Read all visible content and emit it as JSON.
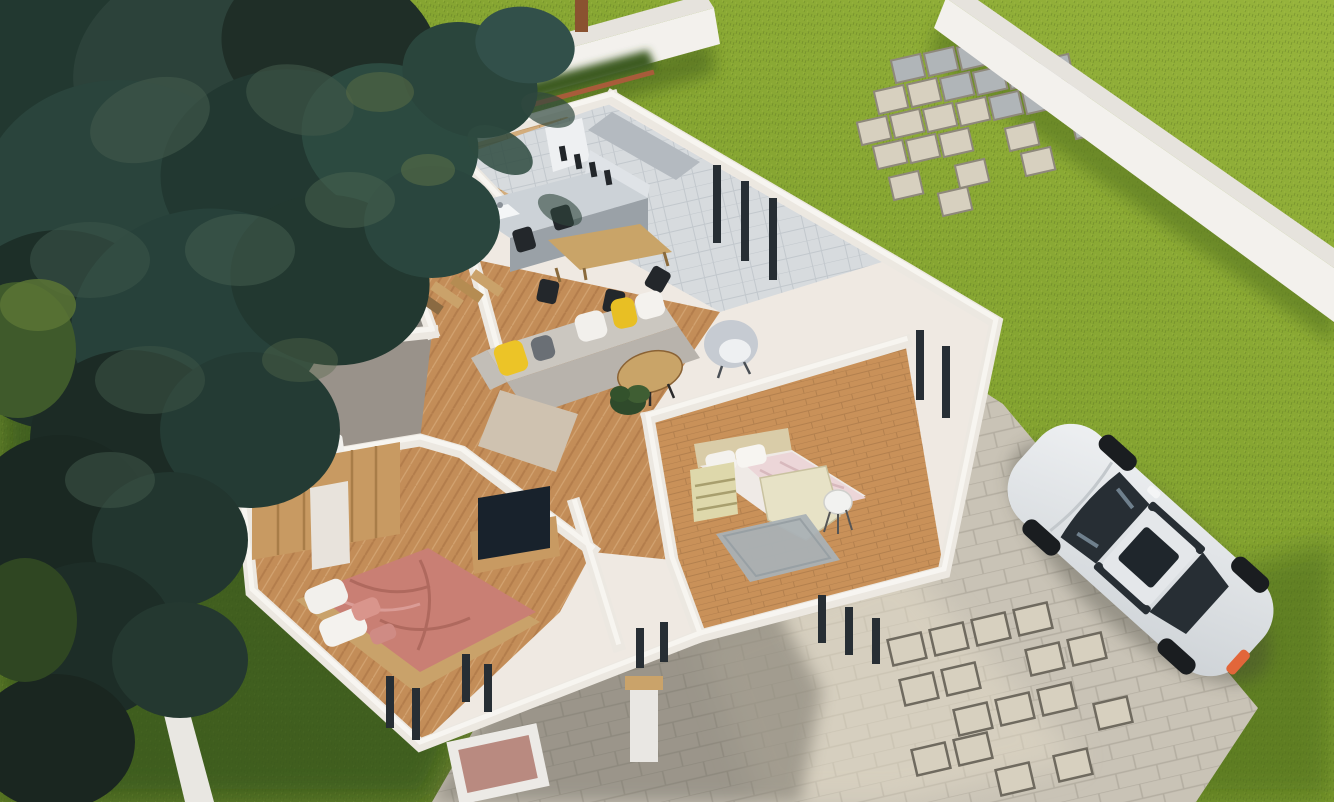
{
  "scene": {
    "type": "3d-architectural-visualization",
    "view": "aerial isometric cutaway (dollhouse) render",
    "description": "Single-story house with roof removed showing furnished rooms, green lawn, white perimeter walls, stone driveway with parked white sedan, paver stepping stones and a large dark conifer tree"
  },
  "yard": {
    "lawn": "grass lawn",
    "perimeter_wall_back": "white boundary wall (top)",
    "perimeter_wall_right": "white boundary wall (right)",
    "driveway": "stone paver driveway and walkways",
    "stepping_stones_top": "scattered square pavers near back wall",
    "stepping_stones_bottom": "scattered square pavers near driveway",
    "planter": "square gravel planter",
    "pillar": "white entry pillar with wood cap",
    "hedge": "dark hedge strip along back wall",
    "tree": "large dark-green conifer tree",
    "bushes": "shrubs along left edge"
  },
  "house": {
    "rooms": [
      {
        "name": "patio-deck",
        "floor": "wood deck",
        "furniture": [
          "round outdoor table",
          "wicker chairs",
          "pergola posts"
        ]
      },
      {
        "name": "kitchen",
        "floor": "light gray tile",
        "furniture": [
          "gray counter island with sink",
          "tall white fridge unit",
          "wall cabinets",
          "utensil rail"
        ]
      },
      {
        "name": "dining-area",
        "floor": "light gray tile",
        "furniture": [
          "wood dining table",
          "black chairs"
        ]
      },
      {
        "name": "living-room",
        "floor": "herringbone oak",
        "furniture": [
          "gray L-shaped sofa",
          "yellow pillows",
          "white pillows",
          "oval wood coffee table",
          "white armchair",
          "potted plant"
        ]
      },
      {
        "name": "hallway",
        "floor": "herringbone oak",
        "furniture": [
          "wood slat coat rack",
          "potted plant"
        ]
      },
      {
        "name": "bathroom-1",
        "floor": "gray concrete",
        "furniture": [
          "navy cabinet",
          "white bathtub"
        ]
      },
      {
        "name": "bathroom-2",
        "floor": "gray concrete",
        "furniture": [
          "white vanity",
          "mirror"
        ]
      },
      {
        "name": "master-bedroom",
        "floor": "herringbone oak",
        "furniture": [
          "oak wardrobe with white sliding door",
          "double bed with rose blanket",
          "white pillows",
          "TV unit",
          "flat TV"
        ]
      },
      {
        "name": "bedroom-2",
        "floor": "oak planks",
        "furniture": [
          "single bed with pink-white bedding",
          "beige headboard",
          "pale dresser",
          "angular desk",
          "white chair",
          "gray rug"
        ]
      }
    ]
  },
  "vehicle": {
    "type": "white sedan",
    "details": [
      "dark tinted glass",
      "sunroof",
      "orange taillight",
      "parked diagonally on pavers"
    ]
  },
  "palette": {
    "lawnBright": "#97b43c",
    "lawnMid": "#80a02e",
    "lawnDark": "#637f25",
    "shadowGreen": "#3d571b",
    "wallFace": "#f3f1ed",
    "wallCap": "#e6e3dd",
    "houseWall": "#ece8e1",
    "houseWallCap": "#f8f6f1",
    "stone": "#c9c3b6",
    "stoneWarm": "#d7d0bf",
    "stoneCool": "#b0b5b8",
    "tile": "#d7dbde",
    "woodFloor": "#c38d58",
    "woodPlank": "#c99159",
    "woodDeck": "#d3ad7c",
    "cabinetGray": "#b4bac0",
    "counterGray": "#ccd2d7",
    "sofaBack": "#cbc7c0",
    "sofaSeat": "#b8b3ac",
    "chaise": "#cfc2b0",
    "pillowYellow": "#ecc427",
    "pillowWhite": "#f2f0ec",
    "tableWood": "#c9a468",
    "chairBlack": "#23272b",
    "armchair": "#c6cbd2",
    "bedRose": "#c97f74",
    "bedWhite": "#efeae6",
    "headboard": "#d9cca8",
    "dresser": "#ded8ab",
    "rugGray": "#aab1b5",
    "wardrobe": "#c89a62",
    "tvDark": "#18222c",
    "bathFloor": "#8f8b84",
    "navyCabinet": "#26303a",
    "carBody": "#eff1f3",
    "carGlass": "#272e34",
    "taillight": "#e2663a",
    "treeDark": "#1f2e27",
    "treeMid": "#2c423a",
    "treeLight": "#41584a",
    "trunk": "#6b4a33",
    "hedge": "#3c5c20",
    "brick": "#a85c3a",
    "pathWhite": "#e9e7e2",
    "planterGravel": "#b98a80"
  }
}
